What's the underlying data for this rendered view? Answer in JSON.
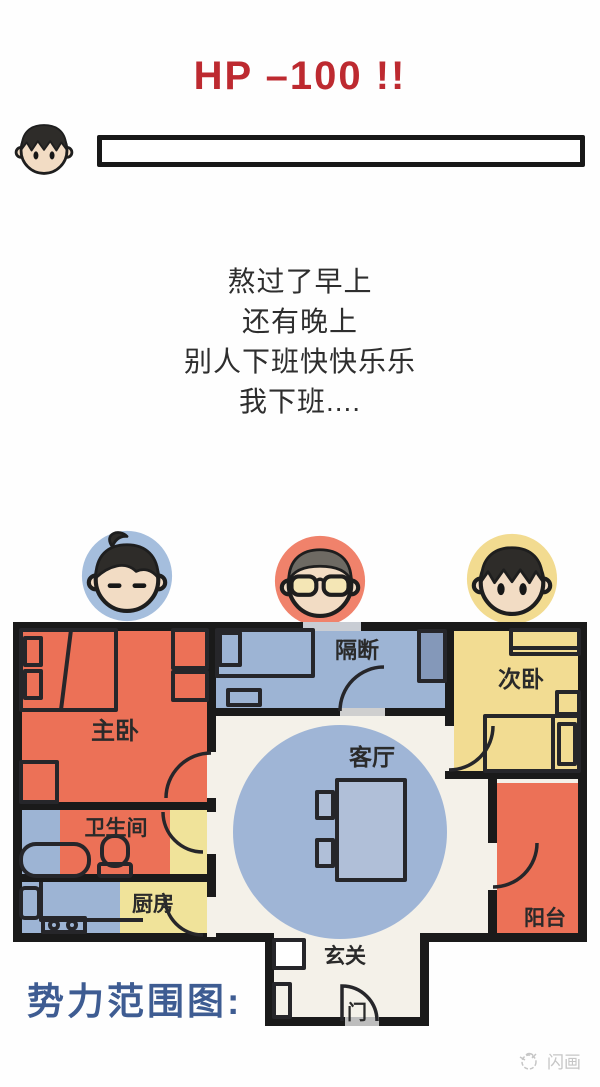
{
  "header": {
    "hp_text": "HP –100 !!",
    "hp_color": "#bd2a30"
  },
  "hp_panel": {
    "character_icon": "boy-face-icon",
    "bar_fill_percent": 0
  },
  "poem": {
    "lines": [
      "熬过了早上",
      "还有晚上",
      "别人下班快快乐乐",
      "我下班...."
    ]
  },
  "legend": {
    "characters": [
      {
        "id": "roommate-blue",
        "icon": "sleepy-face-icon",
        "circle_color": "#a5bedd"
      },
      {
        "id": "roommate-red",
        "icon": "glasses-face-icon",
        "circle_color": "#f0826b"
      },
      {
        "id": "roommate-yellow",
        "icon": "boy-face-icon",
        "circle_color": "#f2db90"
      }
    ]
  },
  "floor_plan": {
    "wall_color": "#1a1a1a",
    "floor_color": "#f4f1e9",
    "influence_circle_color": "#9fb5d6",
    "rooms": {
      "master": {
        "label": "主卧",
        "color": "#ec7157"
      },
      "partition": {
        "label": "隔断",
        "color": "#9db4d4"
      },
      "second": {
        "label": "次卧",
        "color": "#f2dc92"
      },
      "living": {
        "label": "客厅"
      },
      "bathroom": {
        "label": "卫生间",
        "colors": [
          "#9db4d4",
          "#ec7157",
          "#f0e39a"
        ]
      },
      "kitchen": {
        "label": "厨房",
        "colors": [
          "#9db4d4",
          "#f0e39a"
        ]
      },
      "balcony": {
        "label": "阳台",
        "color": "#ec7157"
      },
      "hall": {
        "label": "玄关"
      },
      "door": {
        "label": "门"
      }
    }
  },
  "caption": {
    "label": "势力范围图:",
    "color": "#3e5c92"
  },
  "watermark": {
    "label": "闪画"
  }
}
